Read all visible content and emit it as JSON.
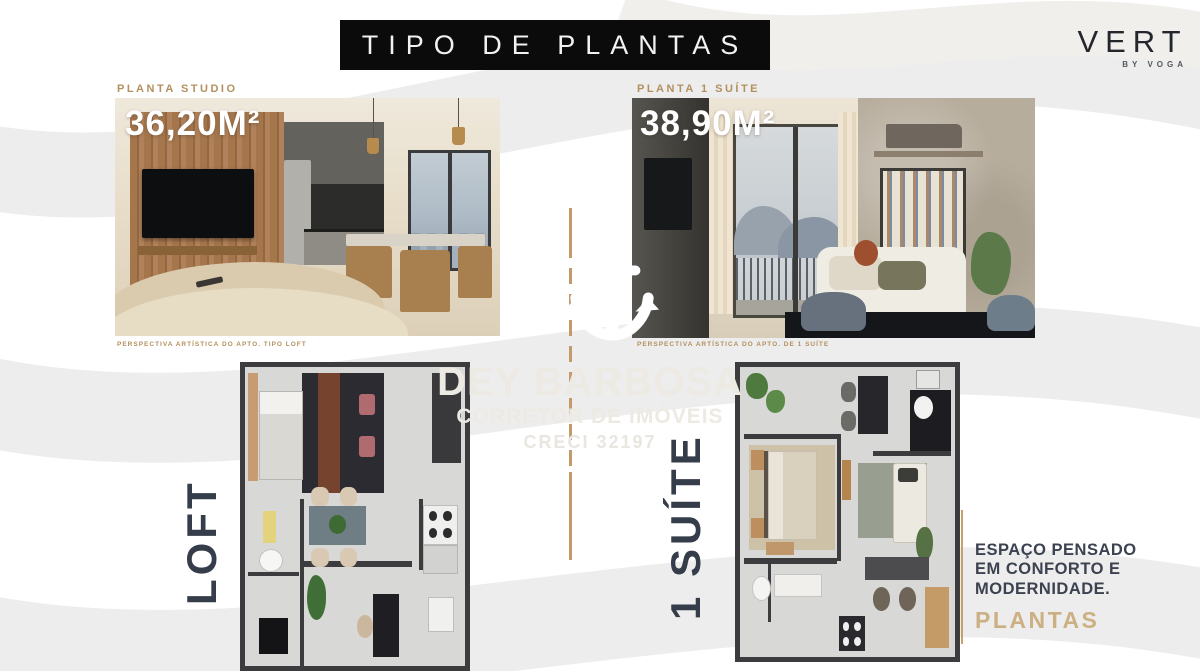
{
  "header": {
    "title": "TIPO DE PLANTAS"
  },
  "brand": {
    "name": "VERT",
    "byline": "BY VOGA"
  },
  "cards": {
    "studio": {
      "label": "PLANTA STUDIO",
      "area": "36,20M²",
      "disclaimer": "PERSPECTIVA ARTÍSTICA DO APTO. TIPO LOFT",
      "plan_label": "LOFT"
    },
    "suite": {
      "label": "PLANTA 1 SUÍTE",
      "area": "38,90M²",
      "disclaimer": "PERSPECTIVA ARTÍSTICA DO APTO. DE 1 SUÍTE",
      "plan_label": "1 SUÍTE"
    }
  },
  "watermark": {
    "name": "DEY BARBOSA",
    "role": "CORRETOR DE IMÓVEIS",
    "registration": "CRECI 32197",
    "icon": "anchor-icon"
  },
  "footer": {
    "lines": [
      "ESPAÇO PENSADO",
      "EM CONFORTO E",
      "MODERNIDADE."
    ],
    "highlight": "PLANTAS"
  },
  "colors": {
    "gold_line": "#c49a6c",
    "gold_label": "#b3905f",
    "gold_highlight": "#ccb083",
    "navy_text": "#353c4a",
    "title_bg": "#0b0b0b"
  }
}
